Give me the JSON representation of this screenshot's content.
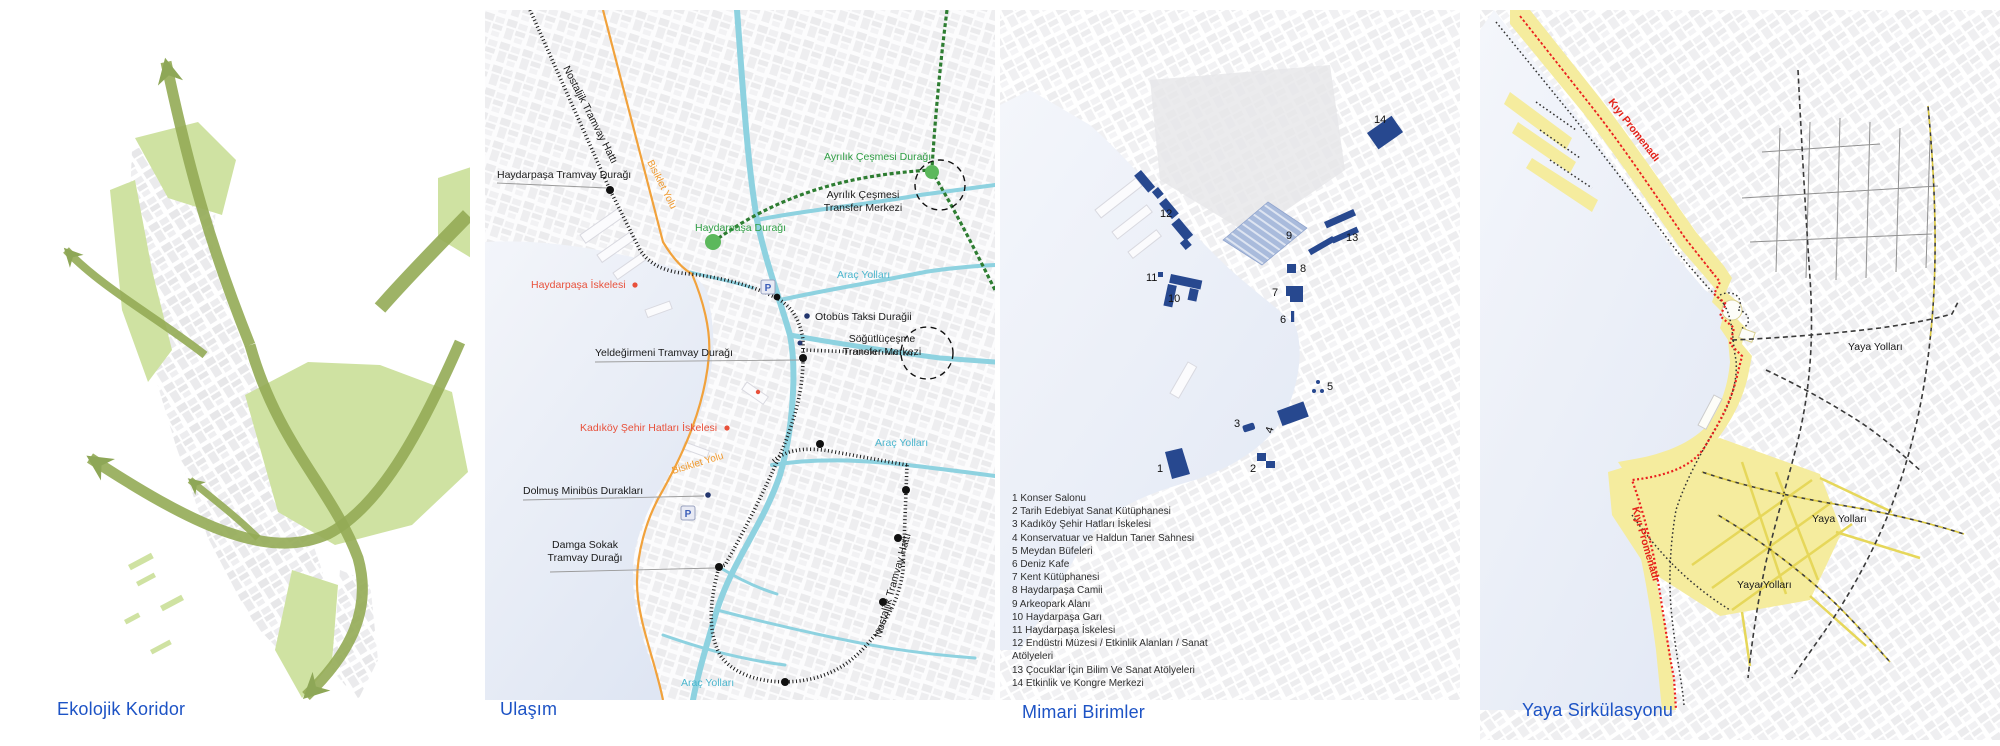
{
  "panels": {
    "ekolojik": {
      "title": "Ekolojik Koridor"
    },
    "ulasim": {
      "title": "Ulaşım",
      "labels": {
        "nostaljik": "Nostaljik Tramvay Hattı",
        "bisiklet": "Bisiklet Yolu",
        "haydarpasa_tramvay": "Haydarpaşa Tramvay Durağı",
        "haydarpasa_duragi": "Haydarpaşa Durağı",
        "ayrilik_duragi": "Ayrılık Çeşmesi Durağı",
        "ayrilik_cesmesi": "Ayrılık Çeşmesi",
        "transfer_merkezi": "Transfer Merkezi",
        "haydarpasa_iskelesi": "Haydarpaşa İskelesi",
        "arac_yollari": "Araç Yolları",
        "otobus": "Otobüs Taksi Durağii",
        "yeldegirmeni": "Yeldeğirmeni Tramvay Durağı",
        "sogutlucesme": "Söğütlüçeşme",
        "kadikoy_iskele": "Kadıköy Şehir Hatları İskelesi",
        "dolmus": "Dolmuş Minibüs Durakları",
        "damga_sokak": "Damga Sokak",
        "tramvay_duragi": "Tramvay Durağı",
        "parking": "P"
      }
    },
    "mimari": {
      "title": "Mimari Birimler",
      "legend": [
        "1 Konser Salonu",
        "2 Tarih Edebiyat Sanat Kütüphanesi",
        "3 Kadıköy Şehir Hatları İskelesi",
        "4 Konservatuar ve Haldun Taner Sahnesi",
        "5 Meydan Büfeleri",
        "6 Deniz Kafe",
        "7 Kent Kütüphanesi",
        "8 Haydarpaşa Camii",
        "9 Arkeopark Alanı",
        "10 Haydarpaşa Garı",
        "11 Haydarpaşa İskelesi",
        "12 Endüstri Müzesi / Etkinlik Alanları / Sanat Atölyeleri",
        "13 Çocuklar İçin Bilim Ve Sanat Atölyeleri",
        "14 Etkinlik ve Kongre Merkezi"
      ],
      "numbers": [
        "1",
        "2",
        "3",
        "4",
        "5",
        "6",
        "7",
        "8",
        "9",
        "10",
        "11",
        "12",
        "13",
        "14"
      ]
    },
    "yaya": {
      "title": "Yaya Sirkülasyonu",
      "labels": {
        "kiyi_promenadi": "Kıyı Promenadı",
        "yaya_yollari": "Yaya Yolları"
      }
    }
  },
  "colors": {
    "title_blue": "#1d53c5",
    "corridor_green": "#93ab55",
    "park_green": "#cfe2a2",
    "tram_black": "#1a1a1a",
    "road_cyan": "#8ed2e0",
    "rail_green": "#2e7d32",
    "stop_green": "#5cb85c",
    "bike_orange": "#f1a23c",
    "ferry_red": "#e8503a",
    "building_navy": "#27488f",
    "arkeopark_blue": "#a9bbdc",
    "promenade_red": "#ee2020",
    "pedestrian_yellow": "#f5ec9e"
  }
}
